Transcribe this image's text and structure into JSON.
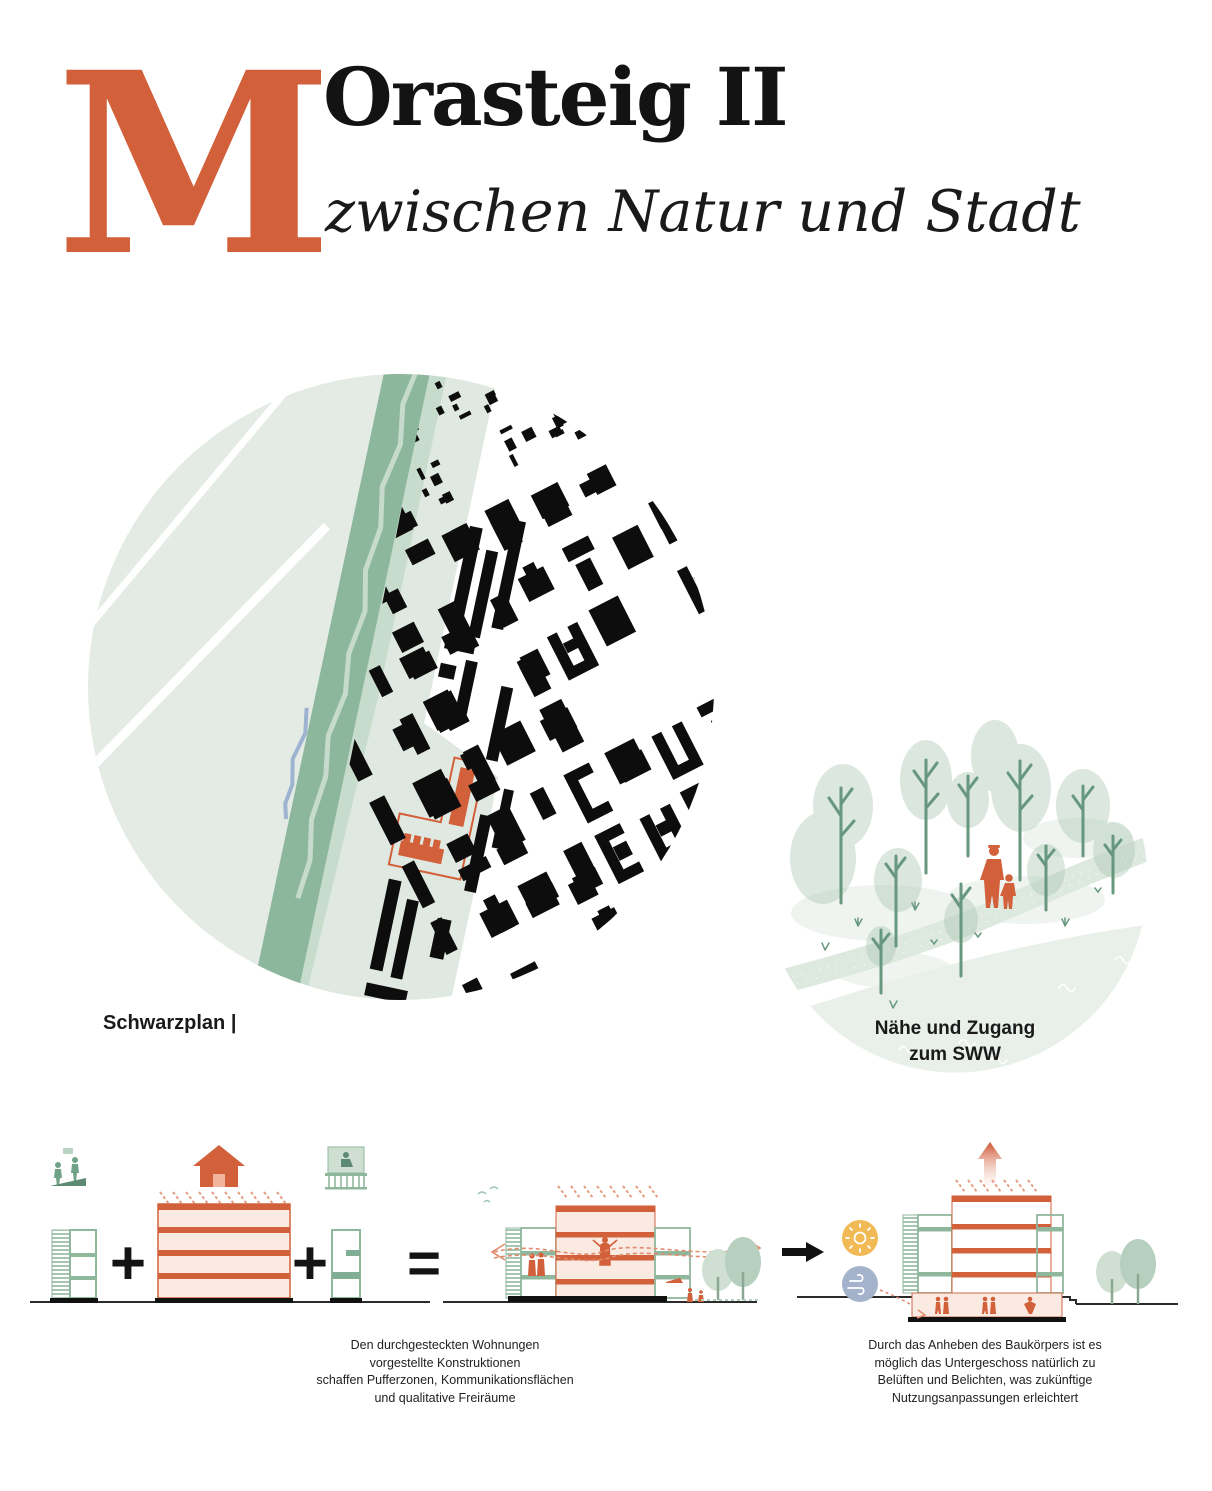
{
  "header": {
    "drop_cap": "M",
    "title": "Orasteig II",
    "subtitle": "zwischen Natur und Stadt"
  },
  "schwarzplan": {
    "label": "Schwarzplan |"
  },
  "sww_circle": {
    "label_line1": "Nähe und Zugang",
    "label_line2": "zum SWW"
  },
  "formula": {
    "plus": "+",
    "equals": "="
  },
  "captions": {
    "left_lines": [
      "Den durchgesteckten Wohnungen",
      "vorgestellte Konstruktionen",
      "schaffen Pufferzonen, Kommunikationsflächen",
      "und qualitative Freiräume"
    ],
    "right_lines": [
      "Durch das Anheben des Baukörpers ist es",
      "möglich das Untergeschoss natürlich zu",
      "Belüften und Belichten, was zukünftige",
      "Nutzungsanpassungen erleichtert"
    ]
  },
  "palette": {
    "accent_orange": "#d2603b",
    "peach_fill": "#faeae1",
    "green": "#6fa287",
    "green_light": "#b9d3c2",
    "pale_green": "#e4ebe4",
    "band_green": "#8cb79d",
    "sun_yellow": "#f1ba55",
    "wind_blue": "#a5b2cc",
    "river_blue": "#9db3cf",
    "ink": "#111111"
  }
}
